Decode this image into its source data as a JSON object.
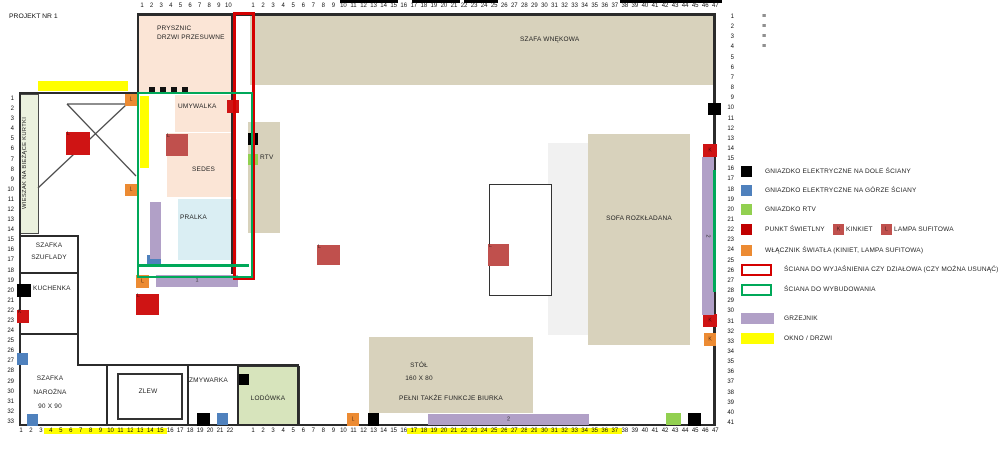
{
  "title": "PROJEKT NR 1",
  "rooms": {
    "prysznic_line1": "PRYSZNIC",
    "prysznic_line2": "DRZWI PRZESUWNE",
    "szafa_wnekowa": "SZAFA WNĘKOWA",
    "umywalka": "UMYWALKA",
    "rtv": "RTV",
    "sedes": "SEDES",
    "pralka": "PRALKA",
    "wieszak": "WIESZAK NA BIEŻĄCE KURTKI",
    "szafka_szuflady_line1": "SZAFKA",
    "szafka_szuflady_line2": "SZUFLADY",
    "kuchenka": "KUCHENKA",
    "szafka_narozna_line1": "SZAFKA",
    "szafka_narozna_line2": "NAROŻNA",
    "szafka_narozna_line3": "90 X 90",
    "zlew": "ZLEW",
    "zmywarka": "ZMYWARKA",
    "lodowka": "LODÓWKA",
    "stol_line1": "STÓŁ",
    "stol_line2": "160 X 80",
    "stol_line3": "PEŁNI TAKŻE FUNKCJE BIURKA",
    "sofa": "SOFA ROZKŁADANA"
  },
  "colors": {
    "outlet_bottom": "#000000",
    "outlet_top": "#4f81bd",
    "outlet_rtv": "#92d050",
    "light_point": "#cf1414",
    "lamp": "#c0504d",
    "switch": "#ec8b33",
    "wall_question": "#d40000",
    "wall_build": "#00a859",
    "heater": "#b1a0c7",
    "window_door": "#ffff00"
  },
  "legend": {
    "items": [
      {
        "key": "outlet-bottom",
        "type": "fill",
        "color": "#000000",
        "y": 166,
        "label": "GNIAZDKO ELEKTRYCZNE NA DOLE ŚCIANY",
        "extras": []
      },
      {
        "key": "outlet-top",
        "type": "fill",
        "color": "#4f81bd",
        "y": 185,
        "label": "GNIAZDKO ELEKTRYCZNE NA GÓRZE ŚCIANY",
        "extras": []
      },
      {
        "key": "outlet-rtv",
        "type": "fill",
        "color": "#92d050",
        "y": 204,
        "label": "GNIAZDKO RTV",
        "extras": []
      },
      {
        "key": "light-point",
        "type": "fill",
        "color": "#c00000",
        "y": 224,
        "label": "PUNKT ŚWIETLNY",
        "extras": [
          {
            "swatch": "K",
            "color": "#c0504d",
            "x": 833,
            "label": "KINKIET"
          },
          {
            "swatch": "L",
            "color": "#c0504d",
            "x": 881,
            "label": "LAMPA SUFITOWA"
          }
        ]
      },
      {
        "key": "light-switch",
        "type": "fill",
        "color": "#ec8b33",
        "y": 245,
        "label": "WŁĄCZNIK ŚWIATŁA (KINIET, LAMPA SUFITOWA)",
        "extras": []
      },
      {
        "key": "wall-question",
        "type": "outline",
        "color": "#d40000",
        "y": 264,
        "label": "ŚCIANA DO WYJAŚNIENIA CZY DZIAŁOWA (CZY MOŻNA USUNĄĆ)",
        "extras": []
      },
      {
        "key": "wall-build",
        "type": "outline",
        "color": "#00a859",
        "y": 284,
        "label": "ŚCIANA DO WYBUDOWANIA",
        "extras": []
      },
      {
        "key": "heater",
        "type": "bar",
        "color": "#b1a0c7",
        "y": 313,
        "label": "GRZEJNIK",
        "extras": []
      },
      {
        "key": "window-door",
        "type": "bar",
        "color": "#ffff00",
        "y": 333,
        "label": "OKNO / DRZWI",
        "extras": []
      }
    ]
  },
  "rulers": {
    "top_inner": {
      "from": 1,
      "to": 10,
      "x": 142,
      "y": 3,
      "dx": 9.6,
      "highlight": []
    },
    "top_main": {
      "from": 1,
      "to": 47,
      "x": 253,
      "y": 3,
      "dx": 10.05,
      "highlight": []
    },
    "bottom_inner": {
      "from": 1,
      "to": 22,
      "x": 21,
      "y": 428,
      "dx": 9.95,
      "highlight": [
        [
          4,
          15
        ]
      ]
    },
    "bottom_main": {
      "from": 1,
      "to": 47,
      "x": 253,
      "y": 428,
      "dx": 10.05,
      "highlight": [
        [
          17,
          37
        ]
      ]
    },
    "right": {
      "from": 1,
      "to": 41,
      "x": 722,
      "y": 14,
      "dy": 10.15
    },
    "left": {
      "from": 1,
      "to": 33,
      "x": 2,
      "y": 96,
      "dy": 10.09
    }
  },
  "top_right_marks": [
    "≡",
    "≡",
    "≡",
    "≡"
  ],
  "markers": [
    {
      "t": "black",
      "x": 708,
      "y": 103,
      "w": 13,
      "h": 12,
      "label": ""
    },
    {
      "t": "black",
      "x": 248,
      "y": 133,
      "w": 10,
      "h": 12,
      "label": ""
    },
    {
      "t": "black",
      "x": 17,
      "y": 284,
      "w": 14,
      "h": 13,
      "label": ""
    },
    {
      "t": "black",
      "x": 239,
      "y": 374,
      "w": 10,
      "h": 11,
      "label": ""
    },
    {
      "t": "black",
      "x": 197,
      "y": 413,
      "w": 13,
      "h": 13,
      "label": ""
    },
    {
      "t": "black",
      "x": 368,
      "y": 413,
      "w": 11,
      "h": 13,
      "label": ""
    },
    {
      "t": "black",
      "x": 688,
      "y": 413,
      "w": 13,
      "h": 13,
      "label": ""
    },
    {
      "t": "blue",
      "x": 147,
      "y": 255,
      "w": 14,
      "h": 12,
      "label": ""
    },
    {
      "t": "blue",
      "x": 17,
      "y": 353,
      "w": 11,
      "h": 12,
      "label": ""
    },
    {
      "t": "blue",
      "x": 27,
      "y": 414,
      "w": 11,
      "h": 12,
      "label": ""
    },
    {
      "t": "blue",
      "x": 217,
      "y": 413,
      "w": 11,
      "h": 12,
      "label": ""
    },
    {
      "t": "green",
      "x": 248,
      "y": 154,
      "w": 10,
      "h": 11,
      "label": ""
    },
    {
      "t": "green",
      "x": 666,
      "y": 413,
      "w": 15,
      "h": 12,
      "label": ""
    },
    {
      "t": "red",
      "x": 66,
      "y": 132,
      "w": 24,
      "h": 23,
      "label": "L",
      "lp": "corner"
    },
    {
      "t": "red",
      "x": 136,
      "y": 294,
      "w": 23,
      "h": 21,
      "label": "L",
      "lp": "corner"
    },
    {
      "t": "red",
      "x": 17,
      "y": 310,
      "w": 12,
      "h": 13,
      "label": "K",
      "lp": "corner"
    },
    {
      "t": "red",
      "x": 227,
      "y": 100,
      "w": 12,
      "h": 13,
      "label": "",
      "lp": "corner"
    },
    {
      "t": "red",
      "x": 703,
      "y": 144,
      "w": 14,
      "h": 13,
      "label": "K",
      "lp": "center"
    },
    {
      "t": "red",
      "x": 703,
      "y": 314,
      "w": 14,
      "h": 13,
      "label": "K",
      "lp": "center"
    },
    {
      "t": "fadedred",
      "x": 166,
      "y": 134,
      "w": 22,
      "h": 22,
      "label": "L",
      "lp": "corner"
    },
    {
      "t": "fadedred",
      "x": 317,
      "y": 245,
      "w": 23,
      "h": 20,
      "label": "L",
      "lp": "corner"
    },
    {
      "t": "fadedred",
      "x": 488,
      "y": 244,
      "w": 21,
      "h": 22,
      "label": "L",
      "lp": "corner"
    },
    {
      "t": "orange",
      "x": 125,
      "y": 94,
      "w": 12,
      "h": 12,
      "label": "L",
      "lp": "center"
    },
    {
      "t": "orange",
      "x": 125,
      "y": 184,
      "w": 12,
      "h": 12,
      "label": "L",
      "lp": "center"
    },
    {
      "t": "orange",
      "x": 136,
      "y": 275,
      "w": 13,
      "h": 13,
      "label": "L",
      "lp": "center"
    },
    {
      "t": "orange",
      "x": 347,
      "y": 413,
      "w": 12,
      "h": 13,
      "label": "L",
      "lp": "center"
    },
    {
      "t": "orange",
      "x": 704,
      "y": 333,
      "w": 12,
      "h": 13,
      "label": "K",
      "lp": "center"
    }
  ],
  "heaters": [
    {
      "x": 150,
      "y": 202,
      "w": 11,
      "h": 57,
      "label": "",
      "vertical": false
    },
    {
      "x": 156,
      "y": 275,
      "w": 82,
      "h": 12,
      "label": "1",
      "vertical": false
    },
    {
      "x": 428,
      "y": 414,
      "w": 161,
      "h": 11,
      "label": "2",
      "vertical": false
    },
    {
      "x": 702,
      "y": 157,
      "w": 12,
      "h": 158,
      "label": "2",
      "vertical": true
    }
  ]
}
